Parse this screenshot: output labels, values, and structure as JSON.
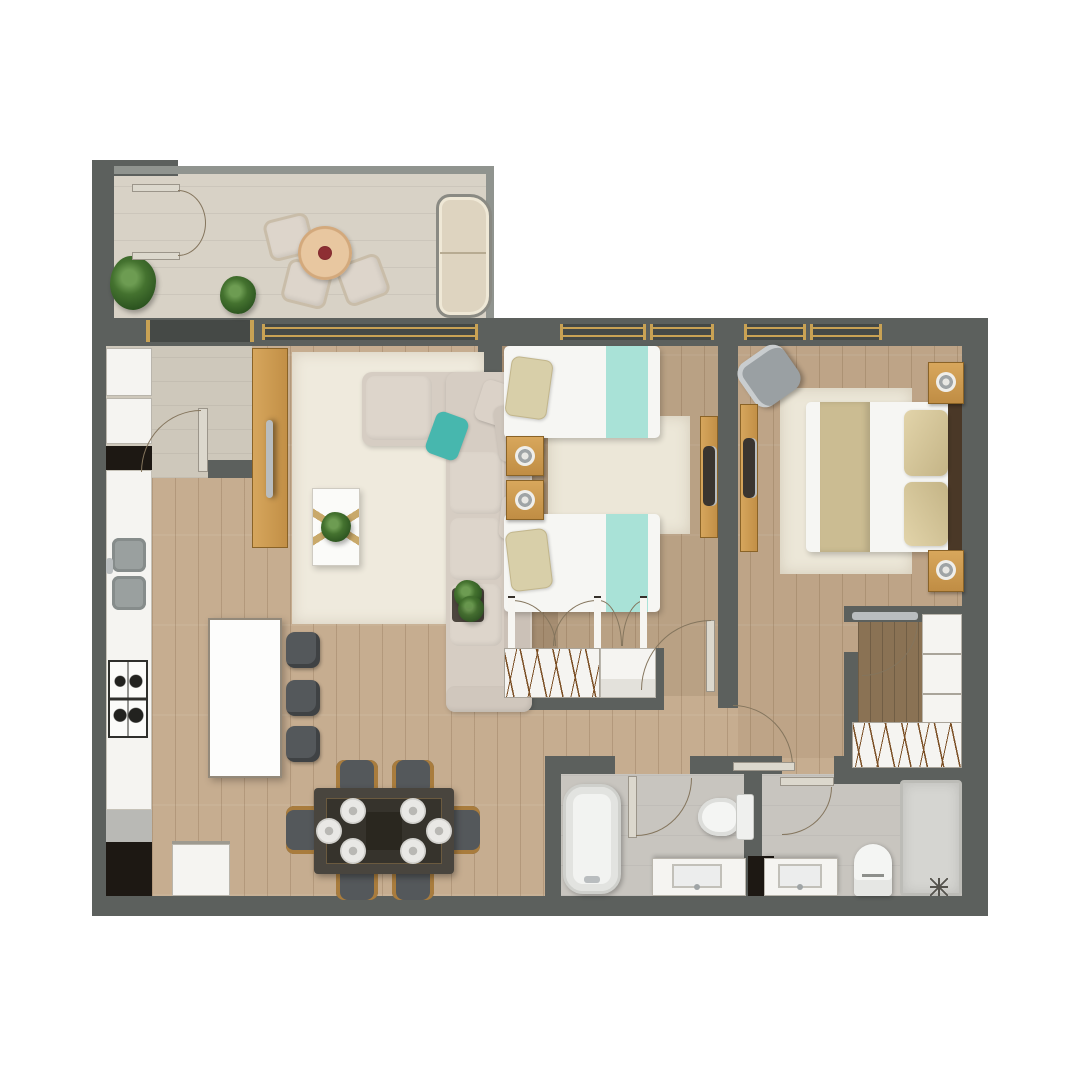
{
  "scene": {
    "kind": "floor-plan",
    "description": "Top-down 3D rendered floor plan of a two-bedroom apartment with balcony, open kitchen/living/dining area, twin bedroom, master bedroom with walk-in closet, and two bathrooms",
    "visible_text": "none"
  },
  "palette": {
    "background": "#ffffff",
    "wall": "#5c605d",
    "wall_dark": "#454946",
    "parapet": "#90948f",
    "balcony_tile": "#d8d2c6",
    "entry_tile": "#cec8bb",
    "wood_floor": "#c6ad90",
    "closet_wood": "#8a7254",
    "rug": "#efeadd",
    "rug_bedroom": "#ece7d8",
    "sofa": "#d6cdc3",
    "sofa_cushion": "#ddd5cb",
    "teal_pillow": "#47b7ae",
    "mint_runner": "#a9e2d7",
    "tan_runner": "#cbbc92",
    "tan_pillow": "#d5c69c",
    "furniture_wood": "#cc9a54",
    "white_furniture": "#f5f4f1",
    "seat_gray": "#54585b",
    "bath_tile": "#c8c5bf",
    "shower_tile": "#d5d5d1",
    "niche_dark": "#1d1813",
    "gold": "#c9a254",
    "silver": "#b9bdbf",
    "plant_green": "#44722f",
    "glass_table": "#36332c",
    "door_line": "#84755d",
    "headboard": "#4a3827"
  },
  "rooms": [
    {
      "id": "balcony",
      "furniture": [
        "french-double-door",
        "armchair",
        "armchair",
        "armchair",
        "round-coffee-table",
        "flower-pot",
        "plant",
        "plant",
        "outdoor-sofa"
      ]
    },
    {
      "id": "entry-hall",
      "furniture": [
        "entry-door",
        "entry-window",
        "fridge",
        "tall-cabinet"
      ]
    },
    {
      "id": "kitchen",
      "furniture": [
        "counter-run",
        "double-sink",
        "gas-stove",
        "lower-cabinet",
        "dark-niche",
        "island",
        "bar-stool",
        "bar-stool",
        "bar-stool",
        "washing-machine"
      ]
    },
    {
      "id": "living-room",
      "furniture": [
        "tv-sideboard",
        "tv",
        "area-rug",
        "sectional-sofa",
        "beige-pillow",
        "beige-pillow",
        "teal-pillow",
        "coffee-table",
        "potted-plant",
        "side-table",
        "floor-plant",
        "sliding-window"
      ]
    },
    {
      "id": "dining-area",
      "furniture": [
        "dining-table",
        "dining-chair",
        "dining-chair",
        "dining-chair",
        "dining-chair",
        "dining-chair",
        "dining-chair",
        "place-setting x6"
      ]
    },
    {
      "id": "bedroom-twin",
      "furniture": [
        "single-bed",
        "single-bed",
        "mint-bed-runner",
        "mint-bed-runner",
        "nightstand",
        "nightstand",
        "table-lamp",
        "table-lamp",
        "bedroom-rug",
        "desk",
        "desk-chair",
        "wardrobe-with-hangers",
        "bifold-closet-doors",
        "door",
        "window",
        "window"
      ]
    },
    {
      "id": "bedroom-master",
      "furniture": [
        "double-bed",
        "tan-bed-runner",
        "headboard",
        "pillow",
        "pillow",
        "nightstand",
        "nightstand",
        "table-lamp",
        "table-lamp",
        "armchair",
        "desk",
        "bedroom-rug",
        "door",
        "window",
        "window"
      ]
    },
    {
      "id": "walk-in-closet",
      "furniture": [
        "sliding-door",
        "open-shelving",
        "wardrobe-with-hangers"
      ]
    },
    {
      "id": "bathroom-main",
      "furniture": [
        "bathtub",
        "toilet",
        "vanity-sink",
        "dark-niche",
        "door"
      ]
    },
    {
      "id": "bathroom-ensuite",
      "furniture": [
        "vanity-sink",
        "toilet",
        "shower",
        "floor-drain",
        "door"
      ]
    },
    {
      "id": "hallway",
      "furniture": []
    }
  ]
}
